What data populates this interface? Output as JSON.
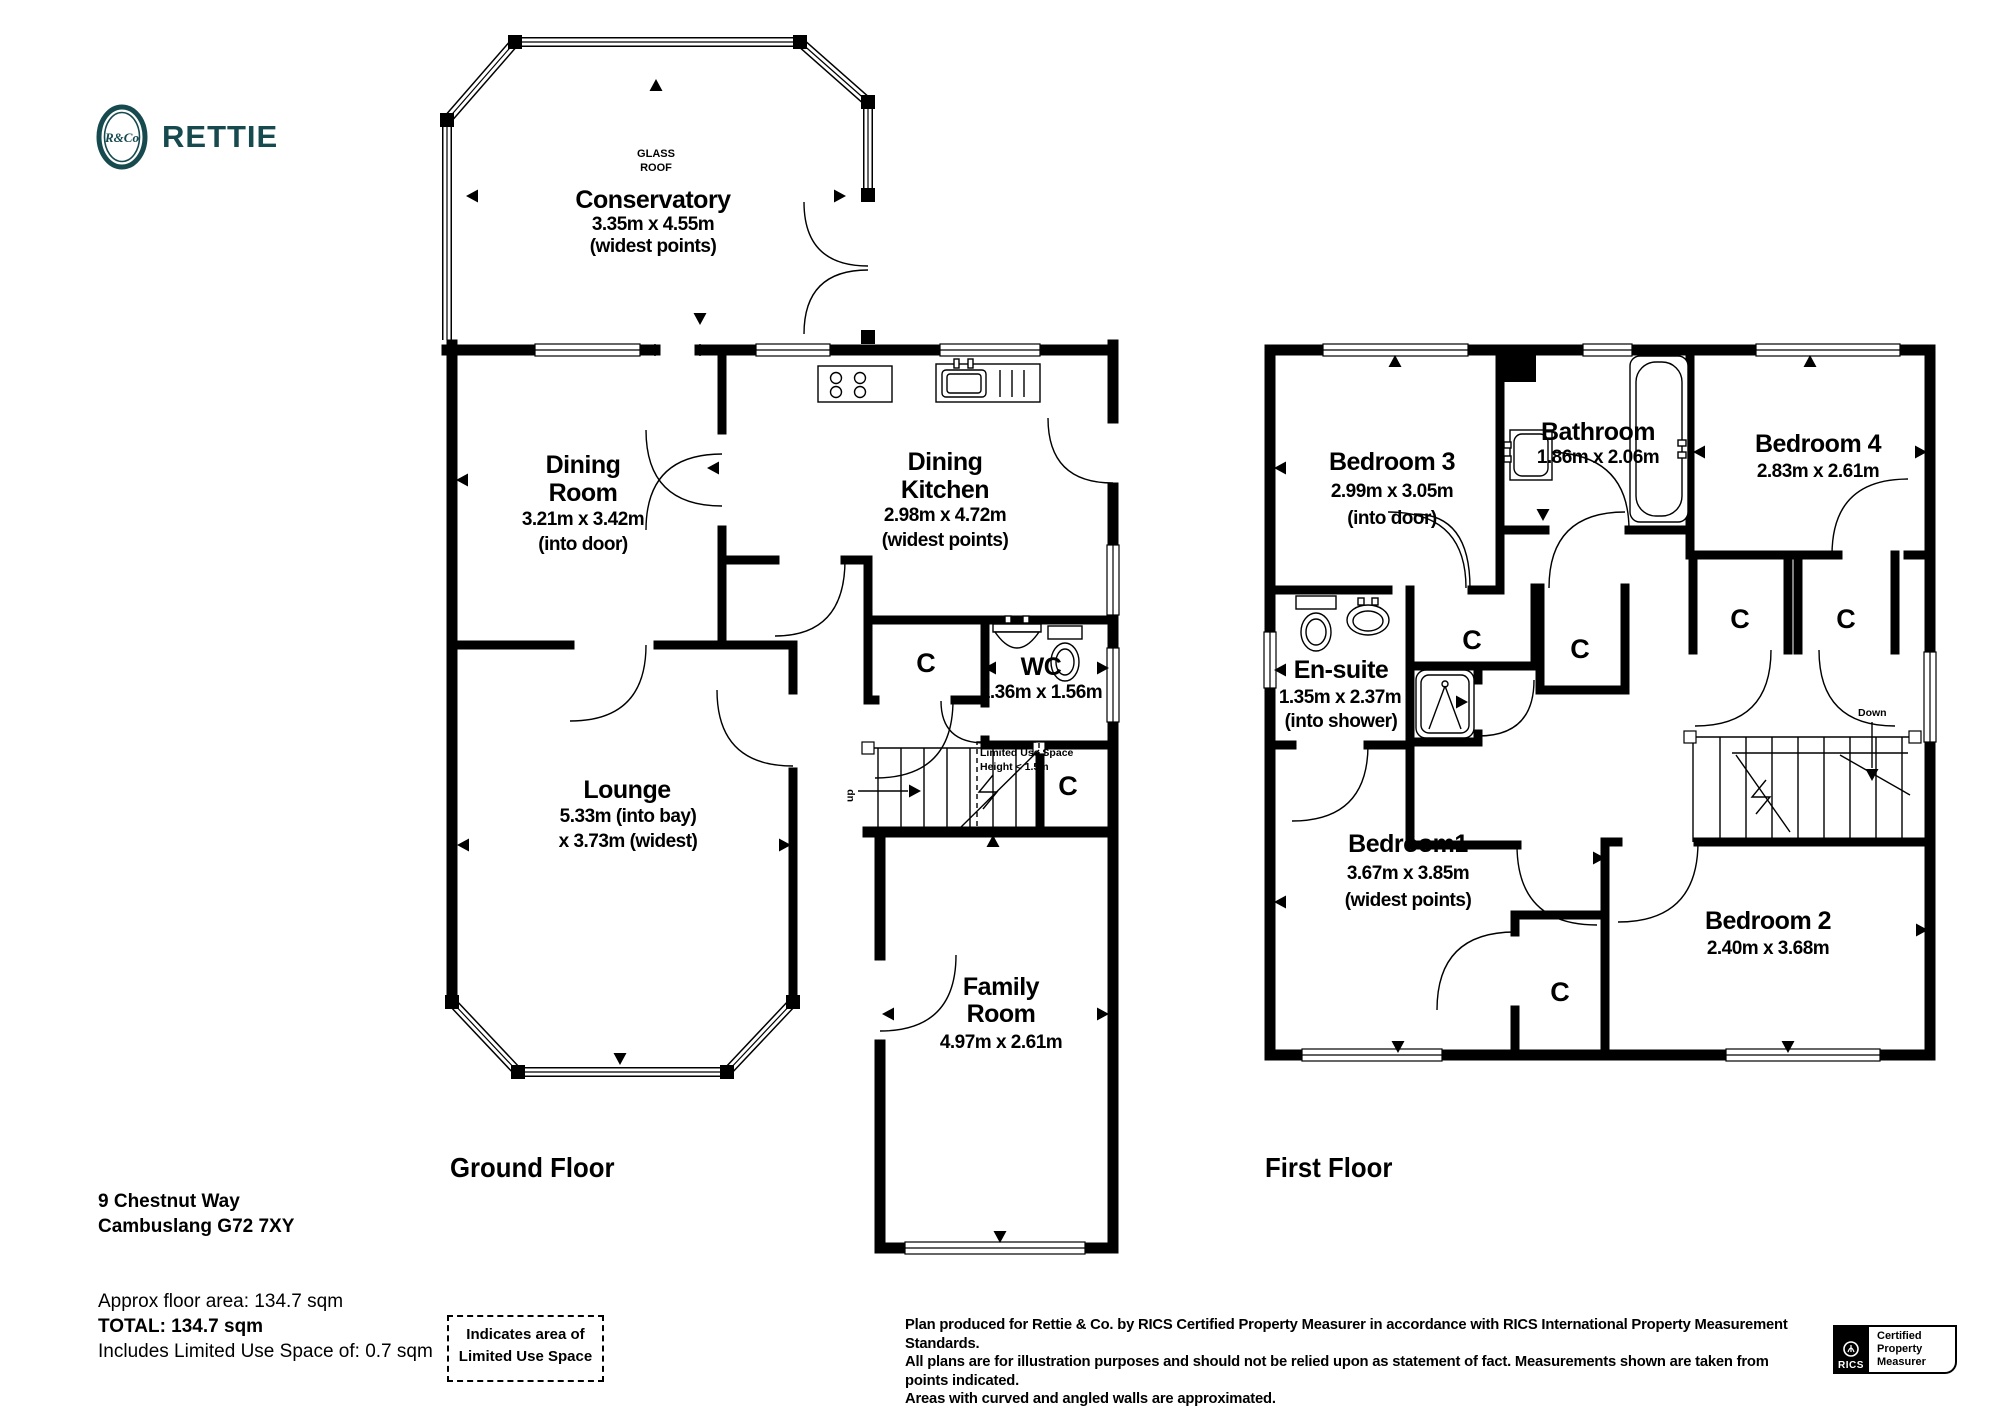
{
  "brand": {
    "name": "RETTIE",
    "monogram": "R&Co",
    "color": "#164a4f"
  },
  "floors": {
    "cupboard": "C",
    "ground": {
      "label": "Ground Floor",
      "roof_line1": "GLASS",
      "roof_line2": "ROOF",
      "conservatory": {
        "name": "Conservatory",
        "dims": "3.35m x 4.55m",
        "note": "(widest points)"
      },
      "dining_room": {
        "name_1": "Dining",
        "name_2": "Room",
        "dims": "3.21m x 3.42m",
        "note": "(into door)"
      },
      "dining_kitchen": {
        "name_1": "Dining",
        "name_2": "Kitchen",
        "dims": "2.98m x 4.72m",
        "note": "(widest points)"
      },
      "wc": {
        "name": "WC",
        "dims": "1.36m x 1.56m"
      },
      "lounge": {
        "name": "Lounge",
        "dims_1": "5.33m (into bay)",
        "dims_2": "x 3.73m (widest)"
      },
      "family_room": {
        "name_1": "Family",
        "name_2": "Room",
        "dims": "4.97m x 2.61m"
      },
      "stairs_up": "up",
      "limited_1": "Limited Use Space",
      "limited_2": "Height < 1.5m"
    },
    "first": {
      "label": "First Floor",
      "bedroom1": {
        "name": "Bedroom1",
        "dims": "3.67m x 3.85m",
        "note": "(widest points)"
      },
      "bedroom2": {
        "name": "Bedroom 2",
        "dims": "2.40m x 3.68m"
      },
      "bedroom3": {
        "name": "Bedroom 3",
        "dims": "2.99m x 3.05m",
        "note": "(into door)"
      },
      "bedroom4": {
        "name": "Bedroom 4",
        "dims": "2.83m x 2.61m"
      },
      "bathroom": {
        "name": "Bathroom",
        "dims": "1.86m x 2.06m"
      },
      "ensuite": {
        "name": "En-suite",
        "dims": "1.35m x 2.37m",
        "note": "(into shower)"
      },
      "stairs_down": "Down"
    }
  },
  "address": {
    "line_1": "9 Chestnut Way",
    "line_2": "Cambuslang G72 7XY"
  },
  "area": {
    "approx": "Approx floor area: 134.7 sqm",
    "total": "TOTAL: 134.7 sqm",
    "includes": "Includes Limited Use Space of: 0.7 sqm"
  },
  "legend": {
    "line_1": "Indicates area of",
    "line_2": "Limited Use Space"
  },
  "disclaimer": {
    "line_1": "Plan produced for Rettie & Co. by RICS Certified Property Measurer in accordance with RICS International Property Measurement Standards.",
    "line_2": "All plans are for illustration purposes and should not be relied upon as statement of fact.  Measurements shown are taken from points indicated.",
    "line_3": "Areas with curved and angled walls are approximated."
  },
  "rics": {
    "name": "RICS",
    "line_1": "Certified",
    "line_2": "Property",
    "line_3": "Measurer"
  }
}
